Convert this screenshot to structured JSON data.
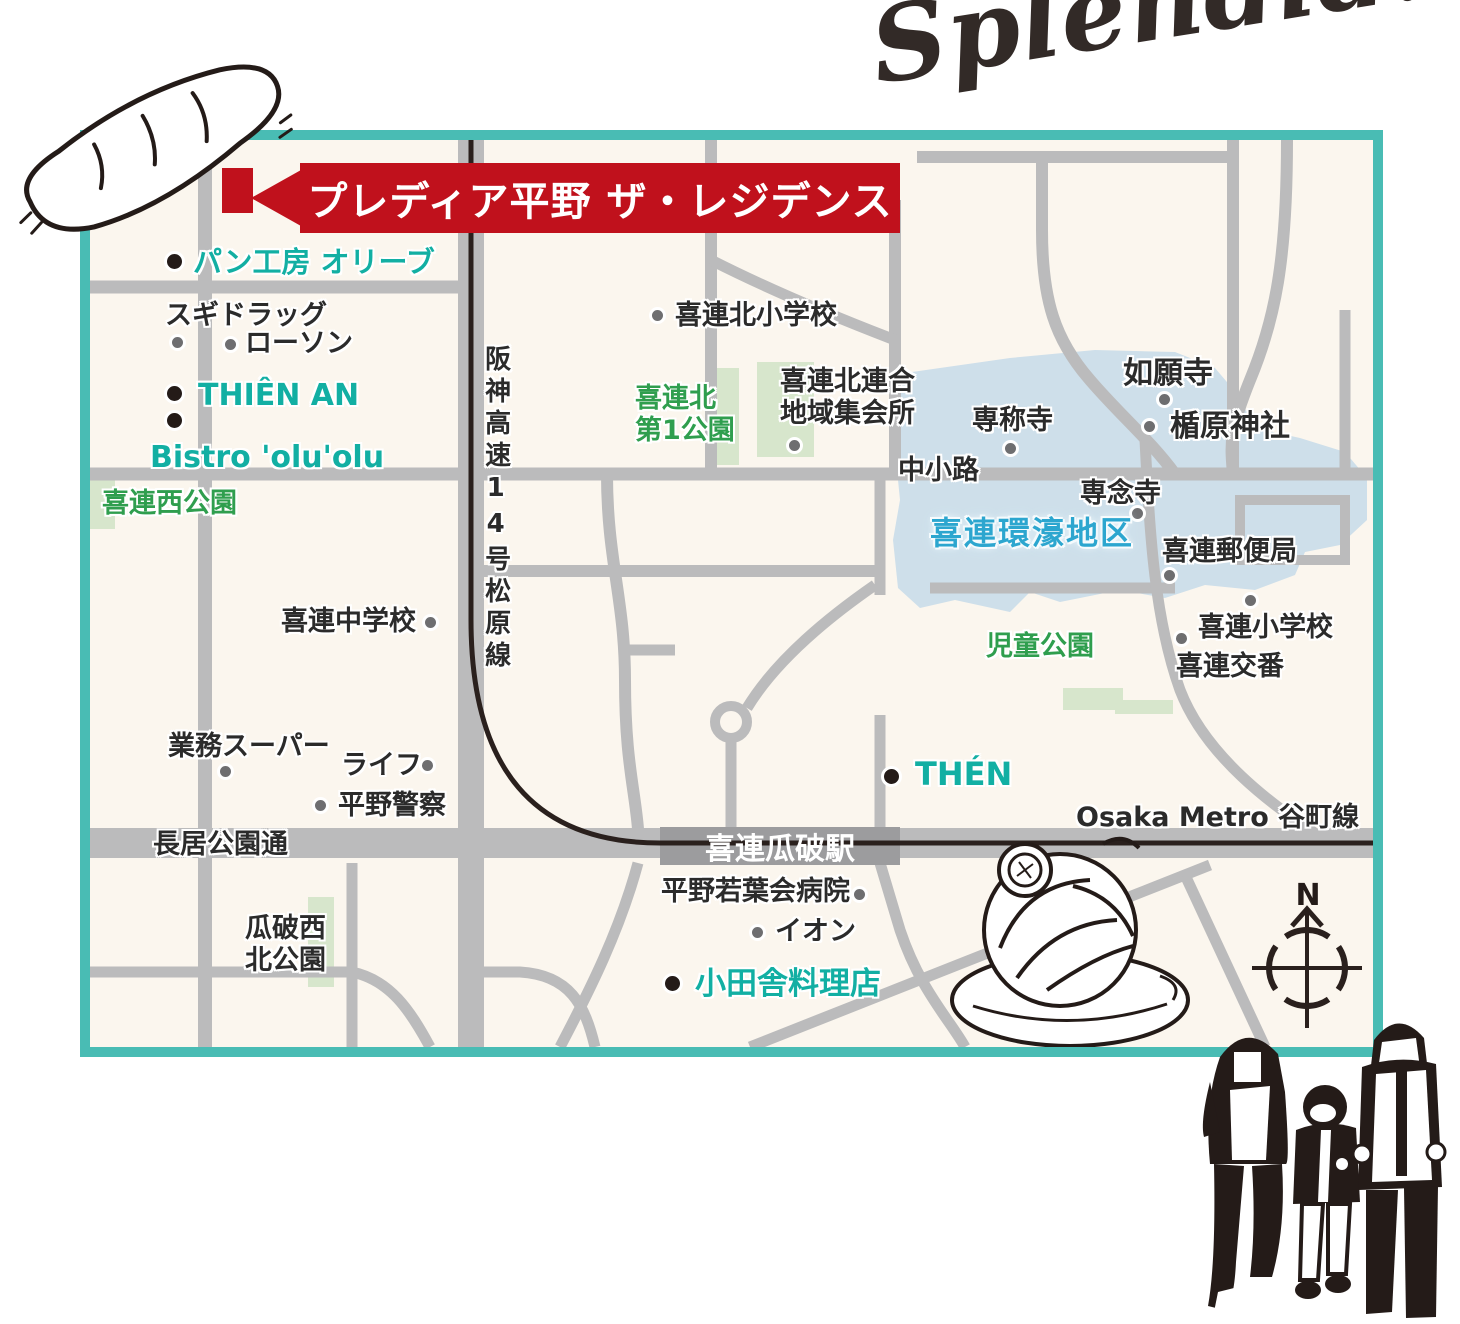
{
  "decorations": {
    "handwritten_note": "Splendid!",
    "compass_label": "N",
    "bread_illustration": "baguette-sketch",
    "pasta_illustration": "spaghetti-plate-sketch",
    "family_illustration": "family-walking-sketch"
  },
  "map": {
    "colors": {
      "border": "#49bcb4",
      "background": "#fbf6ee",
      "road": "#bbbbbc",
      "station_bar": "#9c9c9e",
      "rail_line": "#2a201d",
      "district_fill": "#cedfea",
      "park_fill": "#d7e6cc",
      "accent_red": "#c0111c",
      "teal_label": "#12afa3",
      "green_label": "#2f9e4e",
      "district_label": "#2ca6cf"
    },
    "banner": {
      "label": "プレディア平野 ザ・レジデンス"
    },
    "station": {
      "label": "喜連瓜破駅"
    },
    "rail_line": {
      "label": "Osaka Metro 谷町線"
    },
    "highway": {
      "label": "阪神高速14号松原線"
    },
    "district": {
      "label": "喜連環濠地区"
    },
    "streets": {
      "nakashoji": "中小路",
      "nagai_koen_dori": "長居公園通"
    },
    "parks": {
      "kirenishi": "喜連西公園",
      "kirekita_dai1_line1": "喜連北",
      "kirekita_dai1_line2": "第1公園",
      "jido": "児童公園",
      "uriwari_line1": "瓜破西",
      "uriwari_line2": "北公園"
    },
    "pois": {
      "pan_kobo": "パン工房 オリーブ",
      "sugi_drug": "スギドラッグ",
      "lawson": "ローソン",
      "thien_an": "THIÊN AN",
      "bistro": "Bistro 'olu'olu",
      "kirekita_sho": "喜連北小学校",
      "shukaijo_line1": "喜連北連合",
      "shukaijo_line2": "地域集会所",
      "sensho_ji": "専称寺",
      "nyogan_ji": "如願寺",
      "tatehara": "楯原神社",
      "sennen_ji": "専念寺",
      "yubinkyoku": "喜連郵便局",
      "kire_sho": "喜連小学校",
      "kire_koban": "喜連交番",
      "kire_chu": "喜連中学校",
      "gyomu_super": "業務スーパー",
      "life": "ライフ",
      "hirano_keisatsu": "平野警察",
      "then": "THÉN",
      "hospital": "平野若葉会病院",
      "aeon": "イオン",
      "oinaka": "小田舎料理店"
    }
  }
}
